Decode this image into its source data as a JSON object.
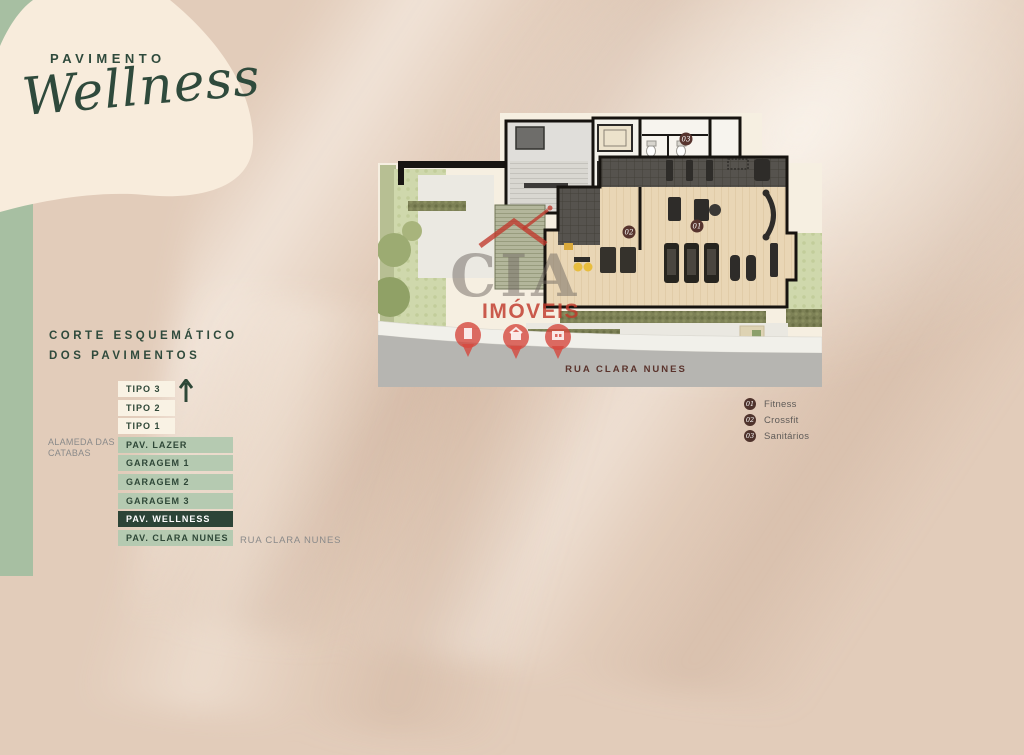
{
  "header": {
    "kicker": "PAVIMENTO",
    "title_script": "Wellness"
  },
  "section_heading": {
    "line1": "CORTE ESQUEMÁTICO",
    "line2": "DOS PAVIMENTOS"
  },
  "floor_stack": {
    "rows": [
      {
        "label": "TIPO 3",
        "variant": "cream"
      },
      {
        "label": "TIPO 2",
        "variant": "cream"
      },
      {
        "label": "TIPO 1",
        "variant": "cream"
      },
      {
        "label": "PAV. LAZER",
        "variant": "sage"
      },
      {
        "label": "GARAGEM 1",
        "variant": "sage"
      },
      {
        "label": "GARAGEM 2",
        "variant": "sage"
      },
      {
        "label": "GARAGEM 3",
        "variant": "sage"
      },
      {
        "label": "PAV. WELLNESS",
        "variant": "dark"
      },
      {
        "label": "PAV. CLARA NUNES",
        "variant": "sage"
      }
    ],
    "left_street_line1": "ALAMEDA DAS",
    "left_street_line2": "CATABAS",
    "right_street_label": "RUA CLARA NUNES"
  },
  "floor_plan": {
    "street_name": "RUA CLARA NUNES",
    "markers": {
      "fitness": "01",
      "crossfit": "02",
      "sanitarios": "03"
    }
  },
  "watermark": {
    "brand": "CIA",
    "word": "IMÓVEIS"
  },
  "legend": {
    "items": [
      {
        "num": "01",
        "label": "Fitness"
      },
      {
        "num": "02",
        "label": "Crossfit"
      },
      {
        "num": "03",
        "label": "Sanitários"
      }
    ]
  },
  "colors": {
    "accent_green": "#2f4a3c",
    "sage": "#b5cab1",
    "band_green": "#a7bfa2",
    "cream": "#f7eddd",
    "dark_row": "#2c4437",
    "marker_maroon": "#57342e",
    "street_text": "#5a332c",
    "watermark_red": "#c0392b"
  }
}
